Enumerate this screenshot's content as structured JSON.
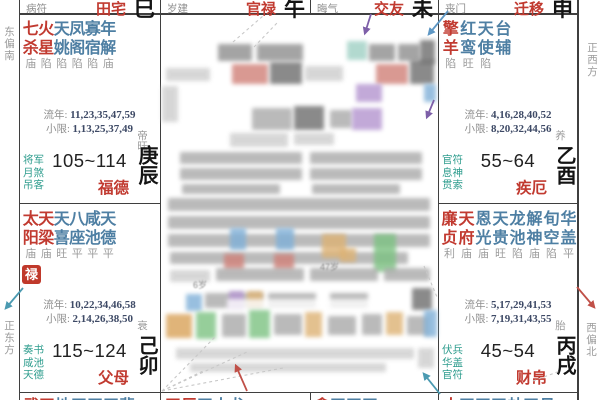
{
  "colors": {
    "red": "#c13a30",
    "starBlue": "#4e7fa3",
    "teal": "#2f9d8e",
    "gray": "#8f8f8f",
    "status": "#9c9c9c",
    "num": "#3e4a66",
    "ink": "#141414",
    "line": "#3f3f3f",
    "dash": "#c8c8c8",
    "badgeBg": "#c0392b",
    "badgeText": "#ffffff",
    "arrow": {
      "purple": "#7d5fa8",
      "blue": "#5e97c4",
      "red": "#c05048",
      "teal": "#4b9ab1"
    }
  },
  "directions": {
    "top_left": "东偏南",
    "bottom_left": "正东方",
    "top_right": "正西方",
    "bottom_right": "西偏北"
  },
  "labels": {
    "liunian": "流年:",
    "xiaoxian": "小限:"
  },
  "strips": [
    {
      "god": "病符",
      "name": "田宅",
      "branch": "巳"
    },
    {
      "god": "岁建",
      "name": "官禄",
      "branch": "午"
    },
    {
      "god": "晦气",
      "name": "交友",
      "branch": "未"
    },
    {
      "god": "丧门",
      "name": "迁移",
      "branch": "申"
    }
  ],
  "palaces": [
    {
      "key": "chen",
      "gods": [
        "将军",
        "月煞",
        "吊客"
      ],
      "stage": "帝旺",
      "range": "105~114",
      "name": "福德",
      "ganzhi": "庚辰",
      "liunian": "11,23,35,47,59",
      "xiaoxian": "1,13,25,37,49",
      "badge": "",
      "stars": [
        {
          "t": "七",
          "b": "杀",
          "s": "庙",
          "c": "red"
        },
        {
          "t": "火",
          "b": "星",
          "s": "陷",
          "c": "red"
        },
        {
          "t": "天",
          "b": "姚",
          "s": "陷",
          "c": "blue"
        },
        {
          "t": "凤",
          "b": "阁",
          "s": "陷",
          "c": "blue"
        },
        {
          "t": "寡",
          "b": "宿",
          "s": "陷",
          "c": "blue"
        },
        {
          "t": "年",
          "b": "解",
          "s": "庙",
          "c": "blue"
        }
      ]
    },
    {
      "key": "mao",
      "gods": [
        "奏书",
        "咸池",
        "天德"
      ],
      "stage": "衰",
      "range": "115~124",
      "name": "父母",
      "ganzhi": "己卯",
      "liunian": "10,22,34,46,58",
      "xiaoxian": "2,14,26,38,50",
      "badge": "禄",
      "stars": [
        {
          "t": "太",
          "b": "阳",
          "s": "庙",
          "c": "red"
        },
        {
          "t": "天",
          "b": "梁",
          "s": "庙",
          "c": "red"
        },
        {
          "t": "天",
          "b": "喜",
          "s": "旺",
          "c": "blue"
        },
        {
          "t": "八",
          "b": "座",
          "s": "平",
          "c": "blue"
        },
        {
          "t": "咸",
          "b": "池",
          "s": "平",
          "c": "blue"
        },
        {
          "t": "天",
          "b": "德",
          "s": "平",
          "c": "blue"
        }
      ]
    },
    {
      "key": "you",
      "gods": [
        "官符",
        "息神",
        "贯索"
      ],
      "stage": "养",
      "range": "55~64",
      "name": "疾厄",
      "ganzhi": "乙酉",
      "liunian": "4,16,28,40,52",
      "xiaoxian": "8,20,32,44,56",
      "badge": "",
      "stars": [
        {
          "t": "擎",
          "b": "羊",
          "s": "陷",
          "c": "red"
        },
        {
          "t": "红",
          "b": "鸾",
          "s": "旺",
          "c": "blue"
        },
        {
          "t": "天",
          "b": "使",
          "s": "陷",
          "c": "blue"
        },
        {
          "t": "台",
          "b": "辅",
          "s": "",
          "c": "blue"
        }
      ]
    },
    {
      "key": "xu",
      "gods": [
        "伏兵",
        "华盖",
        "官符"
      ],
      "stage": "胎",
      "range": "45~54",
      "name": "财帛",
      "ganzhi": "丙戌",
      "liunian": "5,17,29,41,53",
      "xiaoxian": "7,19,31,43,55",
      "badge": "",
      "stars": [
        {
          "t": "廉",
          "b": "贞",
          "s": "利",
          "c": "red"
        },
        {
          "t": "天",
          "b": "府",
          "s": "庙",
          "c": "red"
        },
        {
          "t": "恩",
          "b": "光",
          "s": "庙",
          "c": "blue"
        },
        {
          "t": "天",
          "b": "贵",
          "s": "旺",
          "c": "blue"
        },
        {
          "t": "龙",
          "b": "池",
          "s": "陷",
          "c": "blue"
        },
        {
          "t": "解",
          "b": "神",
          "s": "庙",
          "c": "blue"
        },
        {
          "t": "旬",
          "b": "空",
          "s": "陷",
          "c": "blue"
        },
        {
          "t": "华",
          "b": "盖",
          "s": "平",
          "c": "blue"
        }
      ]
    }
  ],
  "bottom_slivers": [
    {
      "chars": "武天地天天天蜚",
      "reds": 2
    },
    {
      "chars": "天巨天大龙",
      "reds": 2
    },
    {
      "chars": "贪天天天",
      "reds": 1
    },
    {
      "chars": "太天天天劫天月",
      "reds": 1
    }
  ],
  "censor": {
    "palette": {
      "g": "#a9a9a9",
      "l": "#cdcdcd",
      "d": "#8e8e8e",
      "k": "#6e6e6e",
      "r": "#d08078",
      "p": "#b394cf",
      "b": "#7fb0d8",
      "o": "#ddb274",
      "o2": "#d9a258",
      "gr": "#7cc282",
      "t": "#9fd0c4",
      "w": "#ffffff"
    },
    "blocks": [
      [
        218,
        44,
        34,
        17,
        "d"
      ],
      [
        257,
        44,
        46,
        17,
        "d"
      ],
      [
        347,
        41,
        20,
        19,
        "t"
      ],
      [
        369,
        44,
        26,
        17,
        "d"
      ],
      [
        398,
        44,
        22,
        17,
        "d"
      ],
      [
        420,
        40,
        15,
        24,
        "k"
      ],
      [
        166,
        68,
        44,
        13,
        "l"
      ],
      [
        232,
        64,
        36,
        20,
        "r"
      ],
      [
        270,
        62,
        32,
        22,
        "k"
      ],
      [
        305,
        66,
        38,
        15,
        "l"
      ],
      [
        376,
        64,
        32,
        20,
        "r"
      ],
      [
        410,
        60,
        24,
        24,
        "k"
      ],
      [
        162,
        86,
        16,
        36,
        "l"
      ],
      [
        356,
        84,
        26,
        18,
        "p"
      ],
      [
        424,
        84,
        12,
        18,
        "b"
      ],
      [
        252,
        108,
        40,
        22,
        "g"
      ],
      [
        294,
        106,
        30,
        24,
        "k"
      ],
      [
        330,
        110,
        22,
        18,
        "g"
      ],
      [
        352,
        108,
        30,
        22,
        "p"
      ],
      [
        230,
        133,
        58,
        14,
        "l"
      ],
      [
        294,
        133,
        40,
        12,
        "l"
      ],
      [
        180,
        152,
        122,
        12,
        "g"
      ],
      [
        180,
        168,
        122,
        12,
        "g"
      ],
      [
        182,
        184,
        98,
        10,
        "g"
      ],
      [
        310,
        152,
        112,
        12,
        "g"
      ],
      [
        310,
        168,
        112,
        12,
        "g"
      ],
      [
        312,
        184,
        88,
        10,
        "g"
      ],
      [
        168,
        198,
        262,
        13,
        "g"
      ],
      [
        168,
        216,
        262,
        13,
        "g"
      ],
      [
        168,
        234,
        262,
        13,
        "g"
      ],
      [
        170,
        252,
        238,
        12,
        "g"
      ],
      [
        230,
        228,
        16,
        22,
        "b"
      ],
      [
        276,
        228,
        18,
        22,
        "b"
      ],
      [
        224,
        254,
        20,
        16,
        "r"
      ],
      [
        274,
        254,
        20,
        16,
        "r"
      ],
      [
        322,
        234,
        24,
        24,
        "o"
      ],
      [
        374,
        234,
        22,
        38,
        "gr"
      ],
      [
        340,
        248,
        16,
        14,
        "o"
      ],
      [
        170,
        270,
        40,
        12,
        "l"
      ],
      [
        216,
        268,
        88,
        13,
        "g"
      ],
      [
        310,
        268,
        68,
        13,
        "g"
      ],
      [
        384,
        268,
        46,
        13,
        "g"
      ],
      [
        186,
        294,
        16,
        17,
        "b"
      ],
      [
        205,
        293,
        58,
        15,
        "g"
      ],
      [
        229,
        291,
        15,
        19,
        "p"
      ],
      [
        247,
        291,
        16,
        17,
        "o"
      ],
      [
        268,
        293,
        48,
        15,
        "g"
      ],
      [
        330,
        293,
        38,
        15,
        "g"
      ],
      [
        412,
        288,
        20,
        22,
        "k"
      ],
      [
        227,
        299,
        148,
        19,
        "w"
      ],
      [
        166,
        314,
        26,
        24,
        "o2"
      ],
      [
        196,
        312,
        20,
        27,
        "gr"
      ],
      [
        222,
        314,
        24,
        23,
        "g"
      ],
      [
        249,
        310,
        21,
        28,
        "gr"
      ],
      [
        274,
        314,
        28,
        21,
        "g"
      ],
      [
        305,
        312,
        17,
        25,
        "o"
      ],
      [
        328,
        316,
        28,
        19,
        "g"
      ],
      [
        362,
        314,
        20,
        21,
        "g"
      ],
      [
        386,
        312,
        17,
        23,
        "o"
      ],
      [
        407,
        316,
        22,
        19,
        "g"
      ],
      [
        424,
        310,
        13,
        27,
        "b"
      ],
      [
        176,
        348,
        238,
        11,
        "l"
      ],
      [
        190,
        363,
        196,
        9,
        "l"
      ],
      [
        418,
        348,
        16,
        20,
        "l"
      ]
    ],
    "frags": [
      {
        "x": 193,
        "y": 278,
        "t": "6岁"
      },
      {
        "x": 320,
        "y": 260,
        "t": "47岁"
      }
    ]
  },
  "overlay": {
    "arrows": [
      {
        "x1": 371,
        "y1": 14,
        "x2": 365,
        "y2": 33,
        "c": "purple"
      },
      {
        "x1": 448,
        "y1": 11,
        "x2": 429,
        "y2": 34,
        "c": "blue"
      },
      {
        "x1": 434,
        "y1": 100,
        "x2": 427,
        "y2": 117,
        "c": "purple"
      },
      {
        "x1": 247,
        "y1": 391,
        "x2": 236,
        "y2": 366,
        "c": "red"
      },
      {
        "x1": 440,
        "y1": 394,
        "x2": 424,
        "y2": 374,
        "c": "teal"
      },
      {
        "x1": 23,
        "y1": 288,
        "x2": 6,
        "y2": 308,
        "c": "teal"
      },
      {
        "x1": 577,
        "y1": 287,
        "x2": 594,
        "y2": 307,
        "c": "red"
      }
    ],
    "dashes": [
      [
        233,
        42,
        263,
        16
      ],
      [
        254,
        47,
        277,
        23
      ],
      [
        162,
        391,
        216,
        336
      ],
      [
        162,
        391,
        247,
        352
      ],
      [
        162,
        391,
        283,
        368
      ],
      [
        162,
        391,
        205,
        370
      ],
      [
        424,
        266,
        437,
        297
      ],
      [
        533,
        381,
        560,
        371
      ]
    ]
  }
}
